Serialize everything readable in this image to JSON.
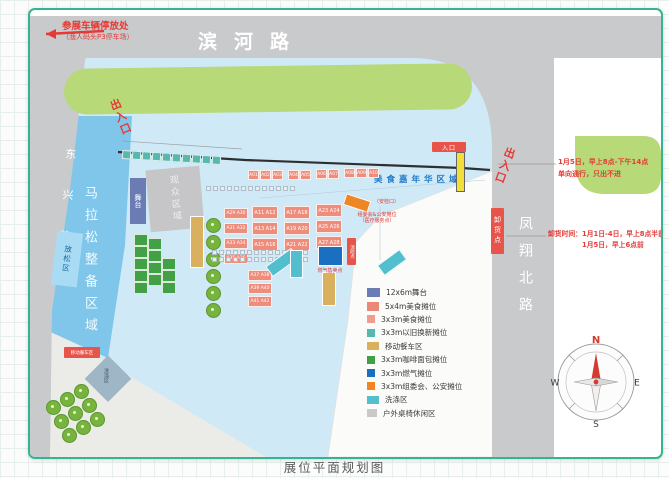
{
  "title": {
    "caption": "展位平面规划图"
  },
  "roads": {
    "top": "滨河路",
    "left": "东兴路",
    "right": "凤翔北路"
  },
  "annotations": {
    "parking_line1": "参展车辆停放处",
    "parking_line2": "（渔人码头P3停车场）",
    "exit_left": "出入口",
    "exit_right": "出入口",
    "gate_tag": "入口",
    "unloading_tag": "卸货点",
    "right_notice_line1": "1月5日，早上8点-下午14点",
    "right_notice_line2": "单向通行，只出不进",
    "unloading_line1": "卸货时间：1月1日-4日，早上8点半前",
    "unloading_line2": "1月5日，早上6点前",
    "carnival_area": "美食嘉年华区域",
    "marathon_area": "马拉松整备区域",
    "relax_area": "放松区",
    "audience_area": "观众区域",
    "stage": "舞台",
    "gas_point": "燃气售卖点",
    "fire_point": "消防点",
    "committee_line1": "组委会&公安摊位",
    "committee_line2": "（医疗服务点）",
    "security_note": "（安检口）",
    "food_truck_tag": "移动餐车区",
    "washing_area": "洗涤区"
  },
  "booths": {
    "a_row": [
      "A01",
      "A02",
      "A03",
      "A04",
      "A05",
      "A06",
      "A07",
      "A08",
      "A09",
      "A10"
    ],
    "left_stack": [
      "A29 A30",
      "A31 A32",
      "A33 A34",
      "A35 A36"
    ],
    "block1": [
      "A11 A12",
      "A13 A14",
      "A15 A16"
    ],
    "block2": [
      "A17 A18",
      "A19 A20",
      "A21 A22"
    ],
    "block3": [
      "A23 A24",
      "A25 A26",
      "A27 A28"
    ],
    "bottom_stack": [
      "A37 A38",
      "A39 A40",
      "A41 A42"
    ]
  },
  "legend": {
    "items": [
      {
        "label": "12x6m舞台",
        "color": "#6b7cb4"
      },
      {
        "label": "5x4m美食摊位",
        "color": "#e98876"
      },
      {
        "label": "3x3m美食摊位",
        "color": "#ef9e8e"
      },
      {
        "label": "3x3m以旧换新摊位",
        "color": "#58b7ae"
      },
      {
        "label": "移动餐车区",
        "color": "#d8b05e"
      },
      {
        "label": "3x3m咖啡面包摊位",
        "color": "#43a047"
      },
      {
        "label": "3x3m燃气摊位",
        "color": "#1a6fc0"
      },
      {
        "label": "3x3m组委会、公安摊位",
        "color": "#ef8626"
      },
      {
        "label": "洗涤区",
        "color": "#53bfce"
      },
      {
        "label": "户外桌椅休闲区",
        "color": "#c9c9c9"
      }
    ]
  },
  "compass": {
    "n": "N",
    "e": "E",
    "s": "S",
    "w": "W"
  },
  "colors": {
    "card_border": "#35b393",
    "road": "#c9cacb",
    "green_median": "#b7d977",
    "venue": "#cfe9f7",
    "marathon_zone": "#7fc6ea",
    "relax_zone": "#a9dcf4",
    "annotation_red": "#e53935",
    "tag_red": "#e8544a",
    "gate_yellow": "#f3df3b"
  }
}
